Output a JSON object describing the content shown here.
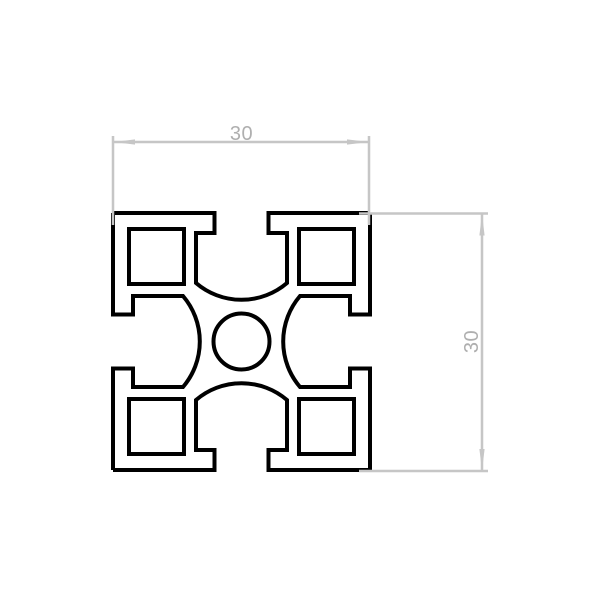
{
  "drawing": {
    "type": "technical-drawing-cross-section",
    "subject": "aluminum-extrusion-t-slot-profile-30x30",
    "colors": {
      "background": "#ffffff",
      "outline": "#000000",
      "dimension_line": "#c6c6c6",
      "dimension_text": "#afafaf"
    },
    "dimensions": {
      "width": {
        "value": "30"
      },
      "height": {
        "value": "30"
      }
    }
  }
}
